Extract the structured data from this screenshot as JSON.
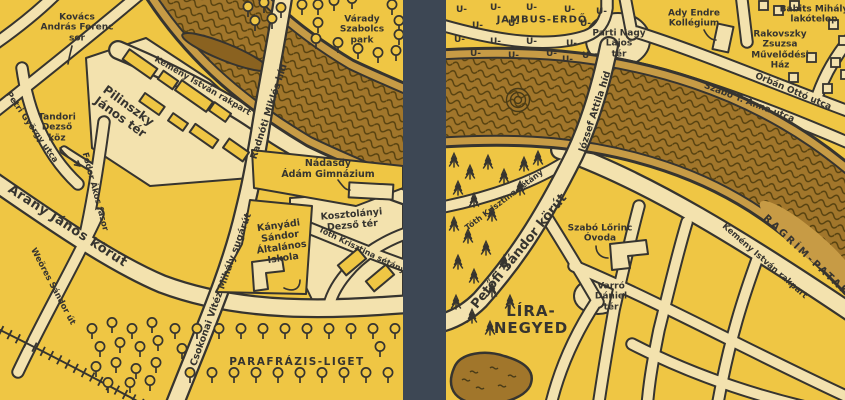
{
  "map_title": "Literary quarter illustrated map (two panels)",
  "palette": {
    "background_yellow": "#efc644",
    "road_cream": "#f3e2ae",
    "ink_dark": "#36342f",
    "river_brown": "#a1762b",
    "river_wave": "#54400f",
    "river_bank": "#c79b45",
    "divider_slate": "#3d4754"
  },
  "left_panel": {
    "labels": {
      "kovacs_andras_ferenc_sor": "Kovács\nAndrás Ferenc\nsor",
      "kemeny_istvan_rakpart": "Kemény István rakpart",
      "radnoti_miklos_hid": "Radnóti Miklós híd",
      "varady_szabolcs_park": "Várady\nSzabolcs\npark",
      "pilinszky_janos_ter": "Pilinszky\nJános tér",
      "tandori_dezso_koz": "Tandori\nDezső\nköz",
      "petri_gyorgy_utca": "Petri György utca",
      "fodor_akos_fasor": "Fodor Ákos fasor",
      "arany_janos_korut": "Arany János körút",
      "weores_sandor_ut": "Weöres Sándor út",
      "csokonai_vitez_mihaly_sugarut": "Csokonai Vitéz Mihály sugárút",
      "nadasdy_adam_gimnazium": "Nádasdy\nÁdám Gimnázium",
      "kanyadi_sandor_altalanos_iskola": "Kányádi\nSándor\nÁltalános\nIskola",
      "kosztolanyi_dezso_ter": "Kosztolányi\nDezső tér",
      "toth_krisztina_setany": "Tóth Krisztina sétány",
      "parafrazis_liget": "PARAFRÁZIS-LIGET"
    }
  },
  "right_panel": {
    "labels": {
      "jambus_erdo": "JAMBUS-ERDŐ",
      "parti_nagy_lajos_ter": "Parti Nagy\nLajos\ntér",
      "jozsef_attila_hid": "József Attila híd",
      "ady_endre_kollegium": "Ady Endre\nKollégium",
      "babits_mihaly_lakotelep": "Babits Mihály\nlakótelep",
      "rakovszky_zsuzsa_muvelodesi_haz": "Rakovszky\nZsuzsa\nMűvelődési\nHáz",
      "orban_otto_utca": "Orbán Ottó utca",
      "szabo_t_anna_utca": "Szabó T. Anna utca",
      "ragrim_patak": "RAGRÍM-PATAK",
      "kemeny_istvan_rakpart": "Kemény István rakpart",
      "toth_krisztina_setany": "Tóth Krisztina sétány",
      "petofi_sandor_korut": "Petőfi Sándor körút",
      "szabo_lorinc_ovoda": "Szabó Lőrinc\nÓvoda",
      "varro_daniel_ter": "Varró\nDániel\ntér",
      "lira_negyed": "LÍRA-\nNEGYED"
    },
    "symbols": {
      "iamb": "U-"
    }
  }
}
